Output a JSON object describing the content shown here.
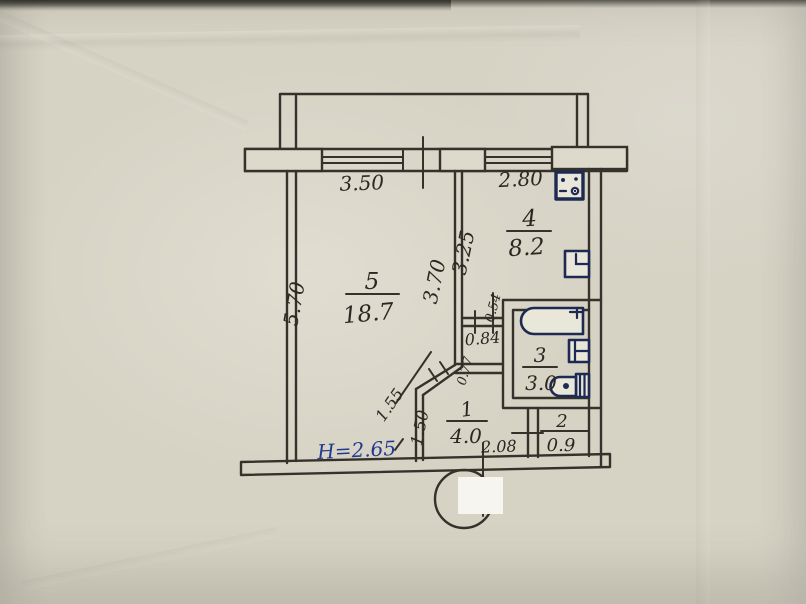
{
  "plan": {
    "title": "apartment-floor-plan",
    "ceiling_height": "H=2.65",
    "rooms": [
      {
        "number": "5",
        "area": "18.7"
      },
      {
        "number": "4",
        "area": "8.2"
      },
      {
        "number": "3",
        "area": "3.0"
      },
      {
        "number": "1",
        "area": "4.0"
      },
      {
        "number": "2",
        "area": "0.9"
      }
    ],
    "dimensions": {
      "living_window": "3.50",
      "kitchen_window": "2.80",
      "living_wall": "5.70",
      "living_depth": "3.70",
      "kitchen_depth": "3.25",
      "shaft_side": "0.54",
      "shaft_width": "0.84",
      "door_offset": "0.77",
      "hall_diagonal": "1.55",
      "hall_side": "1.50",
      "entry_width": "2.08"
    },
    "fixtures": [
      "stove-icon",
      "kitchen-sink-icon",
      "bathtub-icon",
      "washbasin-icon",
      "toilet-icon"
    ],
    "colors": {
      "ink": "#35322b",
      "blue_ink": "#223a8f",
      "fixture_ink": "#1e2a52",
      "paper": "#d6d2c4"
    }
  }
}
